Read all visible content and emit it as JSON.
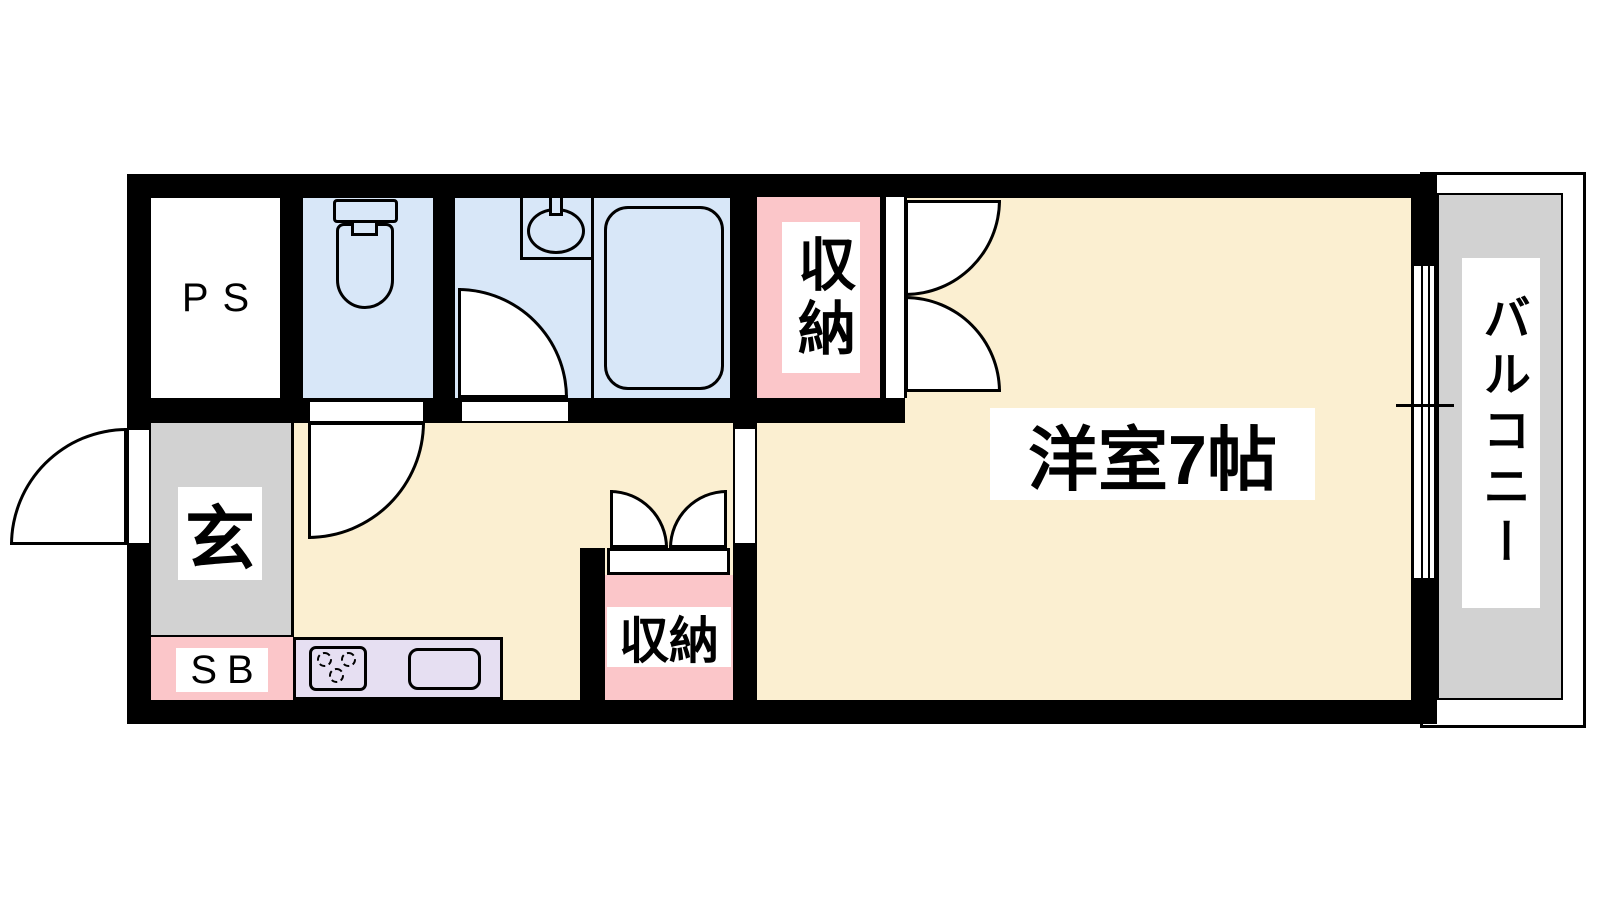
{
  "floor_plan": {
    "type": "apartment-floor-plan",
    "unit_labels": {
      "ps": "PS",
      "entrance": "玄",
      "shoe_box": "SB",
      "closet_upper": "収納",
      "closet_lower": "収納",
      "main_room": "洋室7帖",
      "balcony": "バルコニー"
    },
    "fixtures": [
      "toilet-icon",
      "washbasin-icon",
      "faucet-icon",
      "bathtub-icon",
      "stove-burners-icon",
      "kitchen-sink-icon",
      "entry-door-swing",
      "toilet-door-swing",
      "bathroom-door-swing",
      "closet-upper-double-doors",
      "closet-lower-double-doors",
      "sliding-window"
    ],
    "colors": {
      "wall": "#000000",
      "floor": "#FBEFD1",
      "wet_area": "#D8E7F8",
      "closet": "#FBC6C9",
      "kitchen": "#E6DFF2",
      "entrance_and_balcony": "#D2D2D2",
      "label_background": "#FFFFFF"
    }
  }
}
